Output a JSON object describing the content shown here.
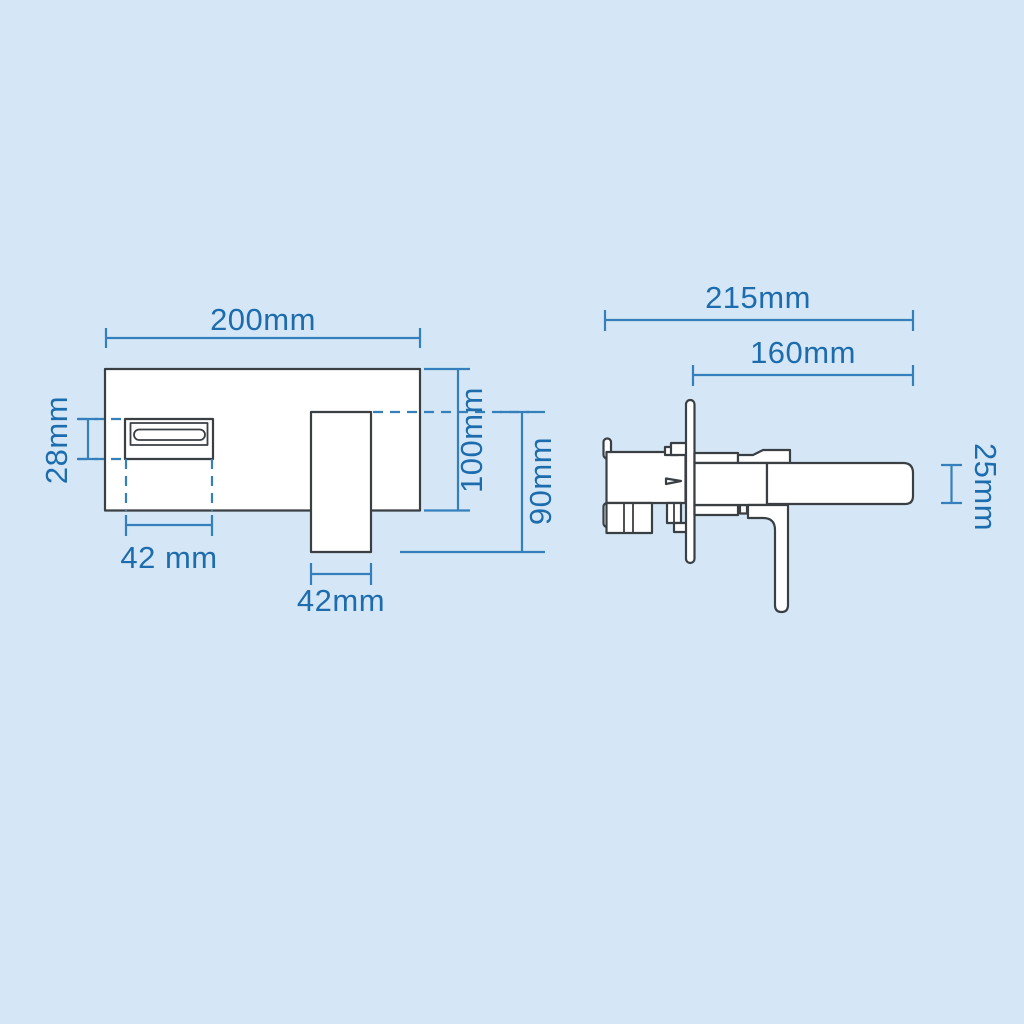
{
  "colors": {
    "background": "#d5e7f6",
    "ink": "#3a3f44",
    "line_blue": "#3580bc",
    "text_blue": "#1d6dae",
    "fill_white": "#ffffff"
  },
  "front_view": {
    "dims": {
      "plate_width": "200mm",
      "spout_height": "28mm",
      "spout_width": "42 mm",
      "handle_width": "42mm",
      "plate_height": "100mm",
      "handle_drop": "90mm"
    }
  },
  "side_view": {
    "dims": {
      "overall_depth": "215mm",
      "spout_reach": "160mm",
      "spout_thickness": "25mm"
    }
  }
}
